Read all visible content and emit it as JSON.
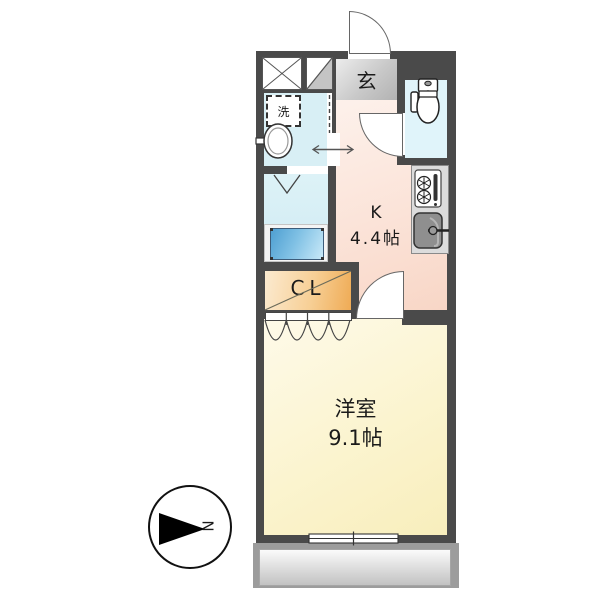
{
  "floorplan": {
    "entrance": {
      "label": "玄"
    },
    "laundry": {
      "label": "洗"
    },
    "kitchen": {
      "label": "K",
      "size": "4.4帖"
    },
    "closet": {
      "label": "CL"
    },
    "western_room": {
      "label": "洋室",
      "size": "9.1帖"
    },
    "compass": {
      "north_label": "N"
    },
    "colors": {
      "wall": "#4a4a4a",
      "wet_area": "#d8eff5",
      "toilet_room": "#e0f4fa",
      "kitchen_floor": "#f9ddcf",
      "entrance_floor": "#cfcfcf",
      "closet": "#f3bb6d",
      "room_floor": "#faf2c6",
      "bathtub": "#55a1d3",
      "balcony": "#cbcbcb"
    },
    "fixtures": [
      "entrance-door",
      "toilet",
      "kitchen-stove",
      "kitchen-sink",
      "washbasin",
      "washing-machine-space",
      "bathtub",
      "sliding-door",
      "bath-folding-door",
      "closet-folding-doors",
      "balcony-window",
      "meter-box",
      "pipe-space"
    ]
  }
}
